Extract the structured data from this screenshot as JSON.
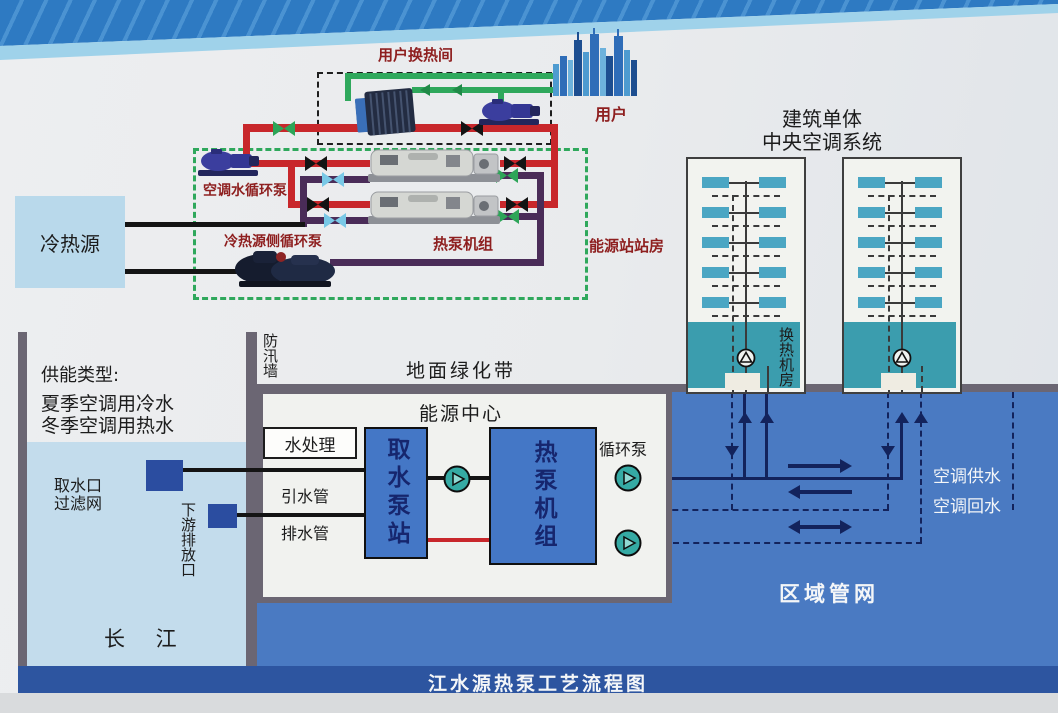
{
  "footer": {
    "title": "江水源热泵工艺流程图"
  },
  "top_schematic": {
    "user_exchange_room": "用户换热间",
    "user": "用户",
    "ac_water_pump": "空调水循环泵",
    "cold_heat_source": "冷热源",
    "source_side_pump": "冷热源侧循环泵",
    "heat_pump_units": "热泵机组",
    "energy_station_room": "能源站站房"
  },
  "buildings": {
    "title_line1": "建筑单体",
    "title_line2": "中央空调系统",
    "heat_exchange_room": "换热机房"
  },
  "river_panel": {
    "supply_type_title": "供能类型:",
    "supply_summer": "夏季空调用冷水",
    "supply_winter": "冬季空调用热水",
    "intake_line1": "取水口",
    "intake_line2": "过滤网",
    "downstream_outlet": "下游排放口",
    "river": "长 江"
  },
  "energy_center": {
    "flood_wall": "防汛墙",
    "greenbelt": "地面绿化带",
    "name": "能源中心",
    "water_treatment": "水处理",
    "intake_pump_station": "取水泵站",
    "heat_pump_unit": "热泵机组",
    "circulation_pump": "循环泵",
    "diversion_pipe": "引水管",
    "drain_pipe": "排水管"
  },
  "district_network": {
    "ac_supply": "空调供水",
    "ac_return": "空调回水",
    "name": "区域管网"
  },
  "colors": {
    "red_pipe": "#c8272b",
    "green_pipe": "#2fa85c",
    "purple_pipe": "#4a2c58",
    "dark_red_label": "#8e1f1f",
    "underground_blue": "#4a7ac2",
    "river_blue": "#c3dcec",
    "box_blue": "#4477c6",
    "teal_room": "#3b9dae",
    "wall_gray": "#6b6673",
    "banner_blue": "#2e7ac2",
    "footer_band": "#2d55a0"
  }
}
